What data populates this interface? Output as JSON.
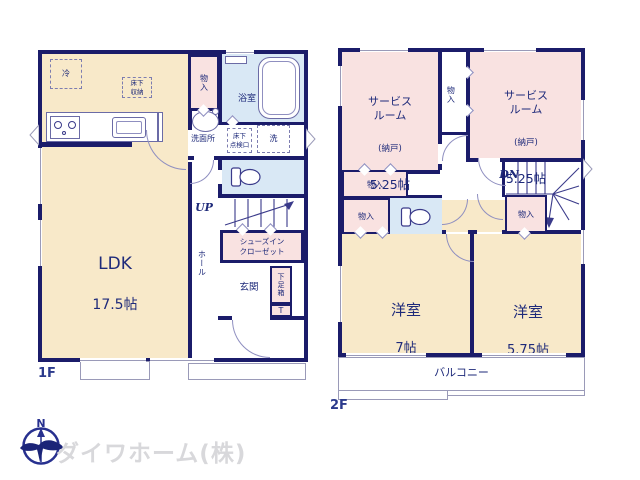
{
  "f1": {
    "floor_label": "1F",
    "ldk_name": "LDK",
    "ldk_size": "17.5帖",
    "refrigerator": "冷",
    "underfloor_storage": "床下\n収納",
    "closet": "物入",
    "bath": "浴室",
    "washroom": "洗面所",
    "underfloor_hatch": "床下\n点検口",
    "laundry": "洗",
    "up_label": "UP",
    "hall": "ホール",
    "shoes_in_closet": "シューズイン\nクローゼット",
    "entrance": "玄関",
    "shoe_box": "下足箱",
    "shoe_box_t": "T"
  },
  "f2": {
    "floor_label": "2F",
    "service_room_left_name": "サービス\nルーム",
    "service_room_left_note": "(納戸)",
    "service_room_left_size": "5.25帖",
    "service_room_right_name": "サービス\nルーム",
    "service_room_right_note": "(納戸)",
    "service_room_right_size": "5.25帖",
    "closet_top": "物入",
    "closet_left_upper": "物入",
    "closet_left_lower": "物入",
    "closet_by_stairs": "物入",
    "dn_label": "DN",
    "bedroom_left_name": "洋室",
    "bedroom_left_size": "7帖",
    "bedroom_right_name": "洋室",
    "bedroom_right_size": "5.75帖",
    "balcony": "バルコニー"
  },
  "branding": {
    "company": "ダイワホーム(株)",
    "compass_north": "N"
  },
  "colors": {
    "wall": "#1b1c6a",
    "cream": "#f8e9c9",
    "pink": "#f9e2e1",
    "blue": "#d9e8f5",
    "navy": "#1e2a7a",
    "line": "#8f8fc0",
    "watermark": "#d8d8db"
  }
}
